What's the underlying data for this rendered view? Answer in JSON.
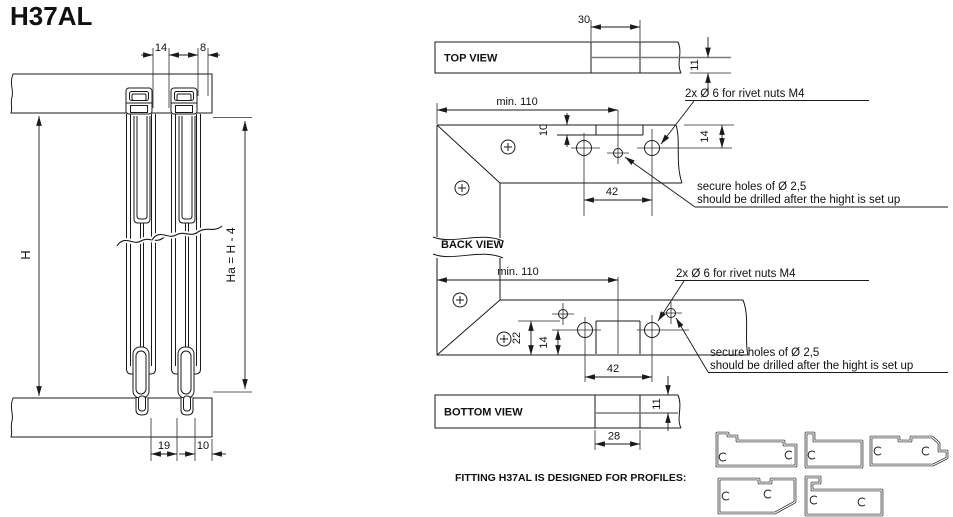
{
  "title": "H37AL",
  "front_view": {
    "dim_gap_top": "14",
    "dim_edge_top": "8",
    "dim_height": "H",
    "dim_height_adj": "Ha = H - 4",
    "dim_gap_bottom": "19",
    "dim_edge_bottom": "10"
  },
  "top_view": {
    "label": "TOP VIEW",
    "dim_tab_width": "30",
    "dim_depth": "11"
  },
  "back_view": {
    "label": "BACK VIEW",
    "upper": {
      "dim_min_width": "min. 110",
      "dim_notch_depth": "10",
      "dim_hole_spacing": "42",
      "dim_hole_offset": "14",
      "note_rivet": "2x Ø 6 for rivet nuts M4",
      "note_secure_1": "secure holes of Ø 2,5",
      "note_secure_2": "should be drilled after the hight is set up"
    },
    "lower": {
      "dim_min_width": "min. 110",
      "dim_offset_22": "22",
      "dim_offset_14": "14",
      "dim_hole_spacing": "42",
      "note_rivet": "2x Ø 6 for rivet nuts M4",
      "note_secure_1": "secure holes of Ø 2,5",
      "note_secure_2": "should be drilled after the hight is set up"
    }
  },
  "bottom_view": {
    "label": "BOTTOM VIEW",
    "dim_tab_width": "28",
    "dim_depth": "11"
  },
  "footer": {
    "note": "FITTING H37AL IS DESIGNED FOR PROFILES:"
  },
  "colors": {
    "line": "#1a1a1a",
    "midline_gray": "#7a7a7a"
  }
}
